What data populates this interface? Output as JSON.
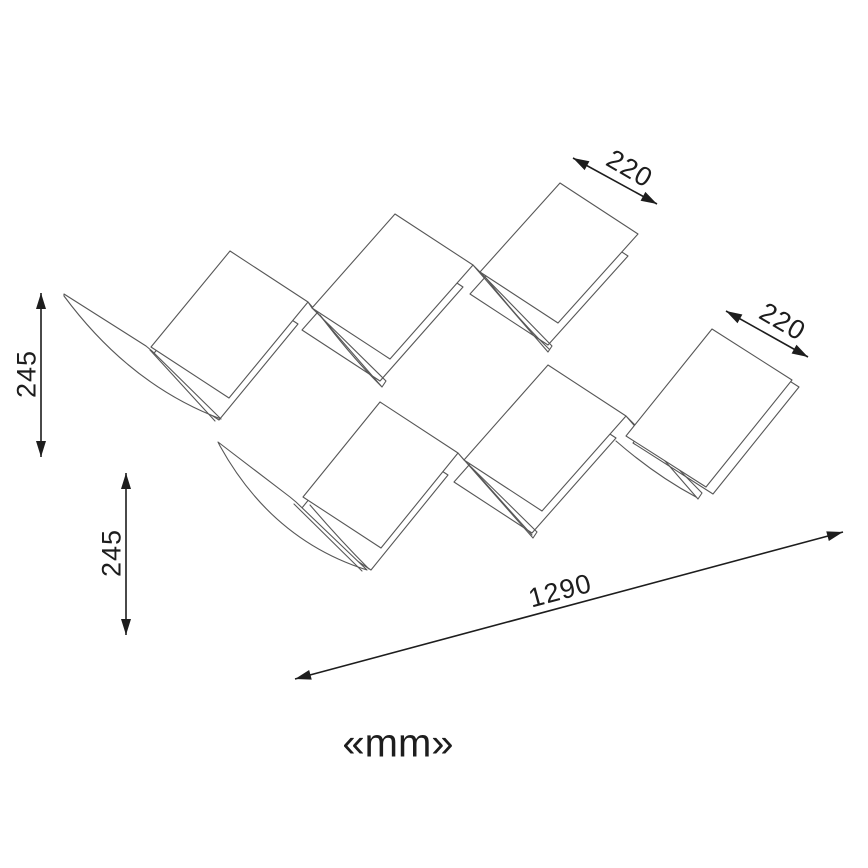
{
  "diagram": {
    "title": "zigzag-shelf-dimension-drawing",
    "unit": {
      "label": "«mm»",
      "x": 398,
      "y": 742
    },
    "dimensions": [
      {
        "id": "top-width",
        "value": "220",
        "x1": 573,
        "y1": 158,
        "x2": 657,
        "y2": 204,
        "lx": 630,
        "ly": 168,
        "rot": 30
      },
      {
        "id": "right-width",
        "value": "220",
        "x1": 726,
        "y1": 311,
        "x2": 808,
        "y2": 357,
        "lx": 783,
        "ly": 321,
        "rot": 30
      },
      {
        "id": "left-height",
        "value": "245",
        "x1": 41,
        "y1": 293,
        "x2": 41,
        "y2": 457,
        "lx": 26,
        "ly": 374,
        "rot": -90
      },
      {
        "id": "lower-height",
        "value": "245",
        "x1": 126,
        "y1": 473,
        "x2": 126,
        "y2": 635,
        "lx": 111,
        "ly": 553,
        "rot": -90
      },
      {
        "id": "length",
        "value": "1290",
        "x1": 295,
        "y1": 679,
        "x2": 843,
        "y2": 532,
        "lx": 560,
        "ly": 590,
        "rot": -15
      }
    ],
    "shelf": {
      "rows": [
        {
          "name": "upper-zigzag",
          "faces": [
            {
              "pts": [
                [
                  230,
                  251
                ],
                [
                  308,
                  302
                ],
                [
                  229,
                  398
                ],
                [
                  151,
                  347
                ]
              ],
              "shadow": [
                -10,
                22
              ]
            },
            {
              "pts": [
                [
                  395,
                  214
                ],
                [
                  473,
                  265
                ],
                [
                  390,
                  359
                ],
                [
                  312,
                  308
                ]
              ],
              "shadow": [
                -10,
                22
              ]
            },
            {
              "pts": [
                [
                  560,
                  183
                ],
                [
                  638,
                  234
                ],
                [
                  558,
                  323
                ],
                [
                  480,
                  272
                ]
              ],
              "shadow": [
                -10,
                22
              ]
            }
          ],
          "strips": [
            [
              [
                308,
                302
              ],
              [
                312,
                308
              ],
              [
                386,
                381
              ],
              [
                382,
                387
              ]
            ],
            [
              [
                473,
                265
              ],
              [
                480,
                272
              ],
              [
                552,
                346
              ],
              [
                548,
                352
              ]
            ]
          ],
          "seams": [
            [
              [
                320,
                315
              ],
              [
                350,
                355
              ],
              [
                381,
                386
              ]
            ],
            [
              [
                486,
                278
              ],
              [
                517,
                318
              ],
              [
                549,
                349
              ]
            ]
          ],
          "wedge": {
            "spine": [
              [
                64,
                294
              ],
              [
                146,
                346
              ],
              [
                152,
                351
              ],
              [
                221,
                419
              ]
            ],
            "curve_ctrl": [
              130,
              385
            ],
            "curve_end": [
              64,
              296
            ],
            "inner": [
              [
                150,
                350
              ],
              [
                215,
                421
              ]
            ]
          }
        },
        {
          "name": "lower-zigzag",
          "faces": [
            {
              "pts": [
                [
                  380,
                  402
                ],
                [
                  458,
                  453
                ],
                [
                  381,
                  548
                ],
                [
                  303,
                  497
                ]
              ],
              "shadow": [
                -10,
                22
              ]
            },
            {
              "pts": [
                [
                  548,
                  365
                ],
                [
                  626,
                  416
                ],
                [
                  542,
                  511
                ],
                [
                  464,
                  460
                ]
              ],
              "shadow": [
                -10,
                22
              ]
            },
            {
              "pts": [
                [
                  712,
                  329
                ],
                [
                  792,
                  380
                ],
                [
                  706,
                  487
                ],
                [
                  626,
                  436
                ]
              ],
              "shadow": [
                7,
                7
              ]
            }
          ],
          "strips": [
            [
              [
                458,
                453
              ],
              [
                464,
                460
              ],
              [
                537,
                532
              ],
              [
                533,
                538
              ]
            ],
            [
              [
                626,
                416
              ],
              [
                633,
                423
              ],
              [
                702,
                493
              ],
              [
                698,
                499
              ]
            ]
          ],
          "seams": [
            [
              [
                310,
                505
              ],
              [
                340,
                540
              ],
              [
                369,
                569
              ]
            ],
            [
              [
                472,
                468
              ],
              [
                502,
                502
              ],
              [
                532,
                535
              ]
            ],
            [
              [
                616,
                441
              ],
              [
                655,
                475
              ],
              [
                696,
                497
              ]
            ]
          ],
          "wedge": {
            "spine": [
              [
                218,
                442
              ],
              [
                290,
                497
              ],
              [
                296,
                502
              ],
              [
                367,
                570
              ]
            ],
            "curve_ctrl": [
              272,
              540
            ],
            "curve_end": [
              220,
              446
            ],
            "inner": [
              [
                294,
                504
              ],
              [
                362,
                571
              ]
            ]
          }
        }
      ]
    },
    "colors": {
      "background": "#ffffff",
      "shelf_line": "#575757",
      "dimension_line": "#1d1d1d",
      "text": "#1d1d1d"
    }
  }
}
